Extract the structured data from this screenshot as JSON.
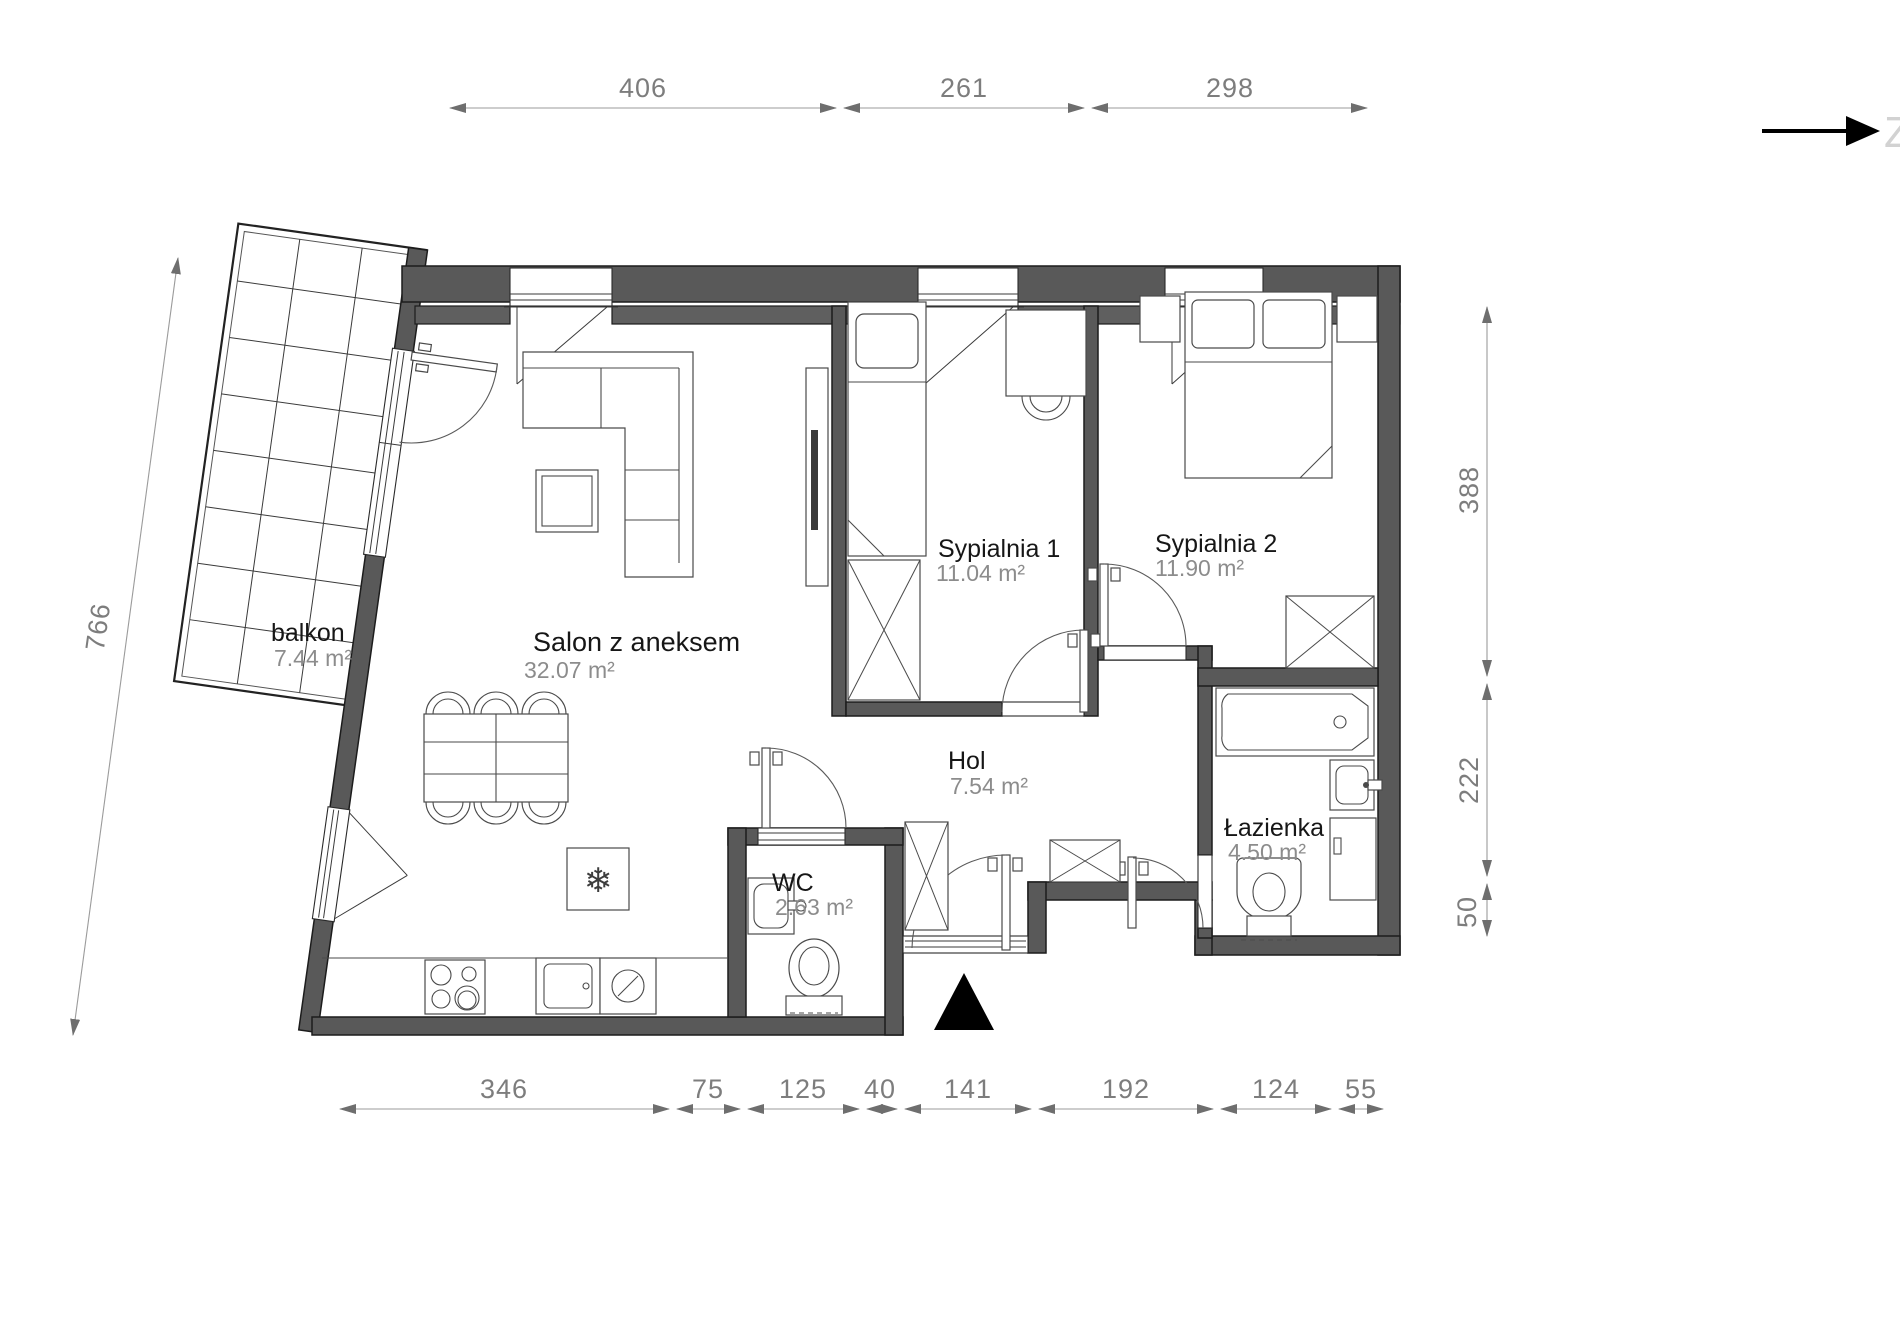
{
  "plan": {
    "rooms": [
      {
        "name": "balkon",
        "area": "7.44 m²"
      },
      {
        "name": "Salon z aneksem",
        "area": "32.07 m²"
      },
      {
        "name": "Sypialnia 1",
        "area": "11.04 m²"
      },
      {
        "name": "Sypialnia 2",
        "area": "11.90 m²"
      },
      {
        "name": "Hol",
        "area": "7.54 m²"
      },
      {
        "name": "WC",
        "area": "2.63 m²"
      },
      {
        "name": "Łazienka",
        "area": "4.50 m²"
      }
    ],
    "dimensions_cm": {
      "top": [
        "406",
        "261",
        "298"
      ],
      "left": [
        "766"
      ],
      "right": [
        "388",
        "222",
        "50"
      ],
      "bottom": [
        "346",
        "75",
        "125",
        "40",
        "141",
        "192",
        "124",
        "55"
      ]
    },
    "north_indicator": {
      "label": "Z"
    },
    "icons": {
      "fridge_glyph": "❄"
    },
    "colors": {
      "wall": "#595959",
      "dimension_text": "#7d7d7d",
      "room_name_text": "#161616",
      "room_area_text": "#8c8c8c",
      "direction_arrow": "#000000"
    }
  }
}
